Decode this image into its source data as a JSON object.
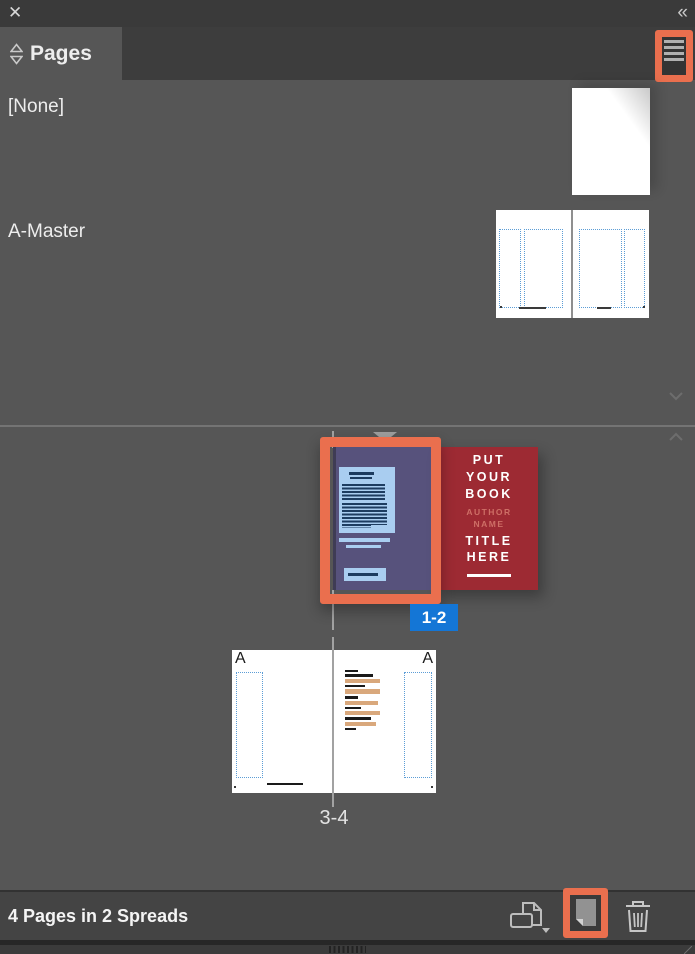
{
  "window": {
    "close_icon": "✕",
    "collapse_icon": "«"
  },
  "tab": {
    "title": "Pages"
  },
  "masters": {
    "none": {
      "label": "[None]"
    },
    "a_master": {
      "label": "A-Master",
      "prefix": "A"
    }
  },
  "spreads": {
    "spread1": {
      "label": "1-2",
      "selected": true
    },
    "spread2": {
      "label": "3-4",
      "selected": false
    }
  },
  "cover": {
    "book": [
      "PUT",
      "YOUR",
      "BOOK"
    ],
    "author": [
      "AUTHOR",
      "NAME"
    ],
    "title": [
      "TITLE",
      "HERE"
    ]
  },
  "status": {
    "summary": "4 Pages in 2 Spreads"
  },
  "colors": {
    "annotation_highlight": "#ea6f4e",
    "selection_blue": "#1476d6",
    "cover_red": "#9d2a33",
    "page_purple": "#57527c",
    "content_light_blue": "#a9cdf0",
    "guide_blue": "#5c9dd6",
    "highlight_tan": "#d9a87c",
    "panel_background": "#565656"
  }
}
